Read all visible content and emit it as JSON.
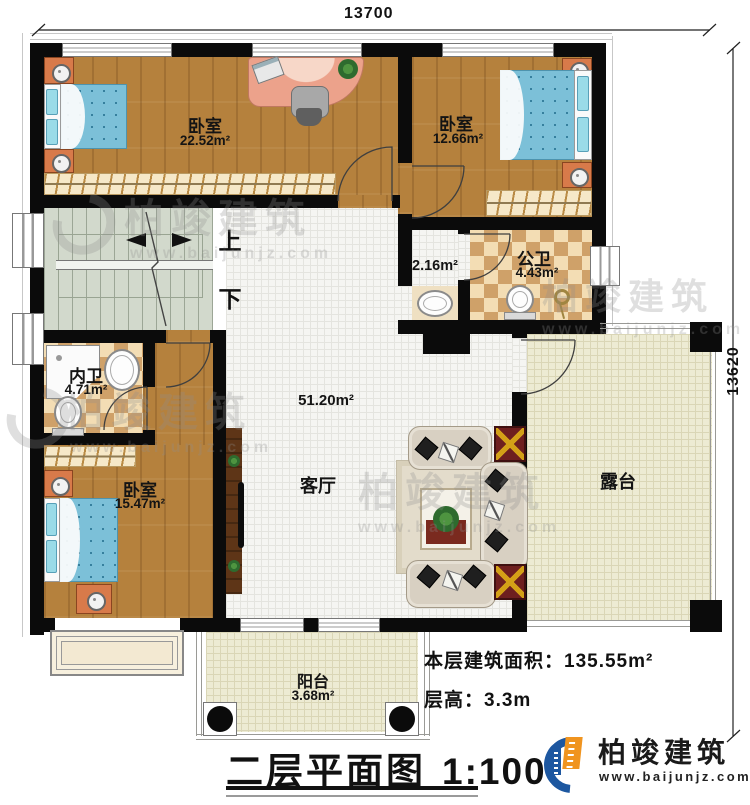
{
  "dimensions": {
    "top_width": "13700",
    "right_height": "13620"
  },
  "rooms": {
    "bedroom1": {
      "name": "卧室",
      "area": "22.52m²"
    },
    "bedroom2": {
      "name": "卧室",
      "area": "12.66m²"
    },
    "bedroom3": {
      "name": "卧室",
      "area": "15.47m²"
    },
    "public_bath": {
      "name": "公卫",
      "area": "4.43m²"
    },
    "ensuite_bath": {
      "name": "内卫",
      "area": "4.71m²"
    },
    "living_room": {
      "name": "客厅",
      "area": "51.20m²"
    },
    "vanity": {
      "area": "2.16m²"
    },
    "terrace": {
      "name": "露台"
    },
    "balcony": {
      "name": "阳台",
      "area": "3.68m²"
    }
  },
  "stairs": {
    "up_label": "上",
    "down_label": "下"
  },
  "info": {
    "area_label": "本层建筑面积：",
    "area_value": "135.55m²",
    "height_label": "层高：",
    "height_value": "3.3m"
  },
  "title": {
    "name": "二层平面图",
    "scale": "1:100"
  },
  "brand": {
    "name": "柏竣建筑",
    "url": "www.baijunjz.com"
  },
  "watermark": {
    "name": "柏竣建筑",
    "url": "www.baijunjz.com"
  },
  "colors": {
    "wall": "#0b0b0b",
    "wood": "#b5813d",
    "living_tile": "#f5f5f2",
    "terrace_tile": "#edebd3",
    "stairs": "#d2d9cc",
    "bath_checker": "#cfa169",
    "bed": "#7cc0d8",
    "brand_blue": "#1d57a0",
    "brand_orange": "#f0941f"
  }
}
